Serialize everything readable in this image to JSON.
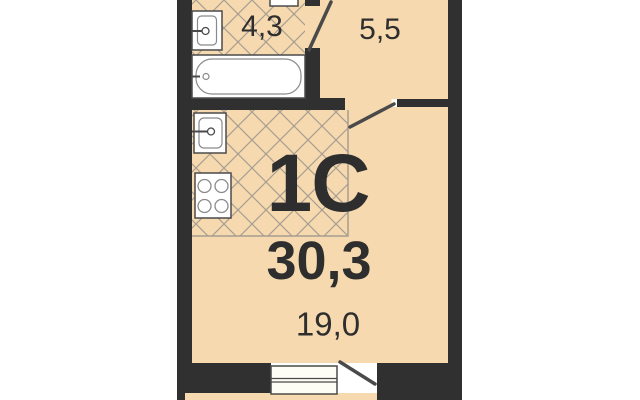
{
  "plan": {
    "code": "1C",
    "total_area": "30,3",
    "rooms": [
      {
        "id": "bathroom",
        "area": "4,3"
      },
      {
        "id": "hallway",
        "area": "5,5"
      },
      {
        "id": "living-room",
        "area": "19,0"
      }
    ],
    "unlabeled_zones": [
      "kitchen"
    ],
    "fixtures": [
      "washbasin",
      "bathtub",
      "kitchen-sink",
      "stove-4-burner",
      "window",
      "balcony-door",
      "bathroom-door",
      "hall-door"
    ],
    "colors": {
      "floor": "#f6d9ae",
      "wall": "#303030",
      "hatch_line": "#a79d92",
      "fixture_stroke": "#4a4a4a",
      "text": "#2e2e2e",
      "background": "#ffffff"
    }
  }
}
